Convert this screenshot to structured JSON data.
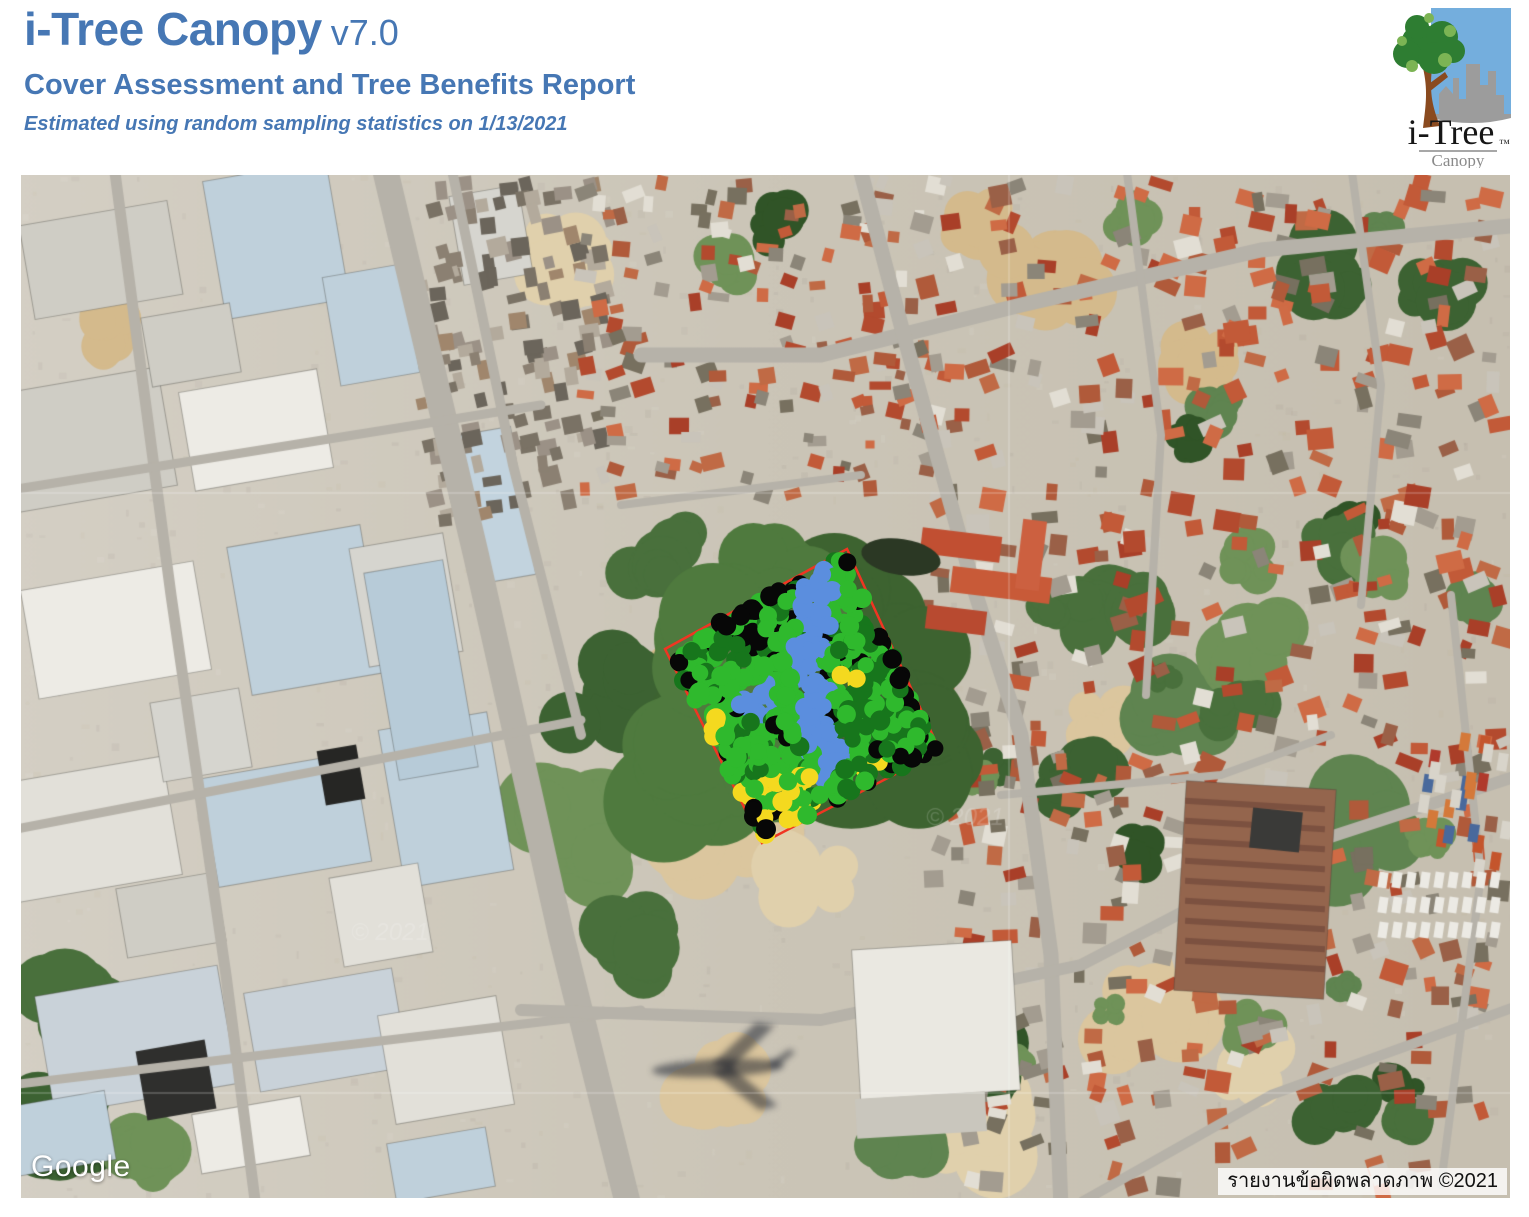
{
  "header": {
    "title": "i-Tree Canopy",
    "version": "v7.0",
    "subtitle": "Cover Assessment and Tree Benefits Report",
    "note": "Estimated using random sampling statistics on 1/13/2021",
    "accent_color": "#4677b4"
  },
  "logo": {
    "brand": "i-Tree",
    "tm": "™",
    "product": "Canopy"
  },
  "map": {
    "google_watermark": "Google",
    "attribution": "รายงานข้อผิดพลาดภาพ ©2021",
    "faint_watermark": "© 2021",
    "survey": {
      "point_count": 650,
      "point_radius_px": 9,
      "boundary_color": "#f03522",
      "polygon_px": [
        [
          644,
          474
        ],
        [
          826,
          374
        ],
        [
          919,
          576
        ],
        [
          741,
          668
        ]
      ],
      "classes": [
        {
          "name": "green",
          "color": "#2fb92d"
        },
        {
          "name": "dark-green",
          "color": "#17761c"
        },
        {
          "name": "black",
          "color": "#070707"
        },
        {
          "name": "blue",
          "color": "#5b8ede"
        },
        {
          "name": "yellow",
          "color": "#f4d91f"
        }
      ]
    }
  }
}
